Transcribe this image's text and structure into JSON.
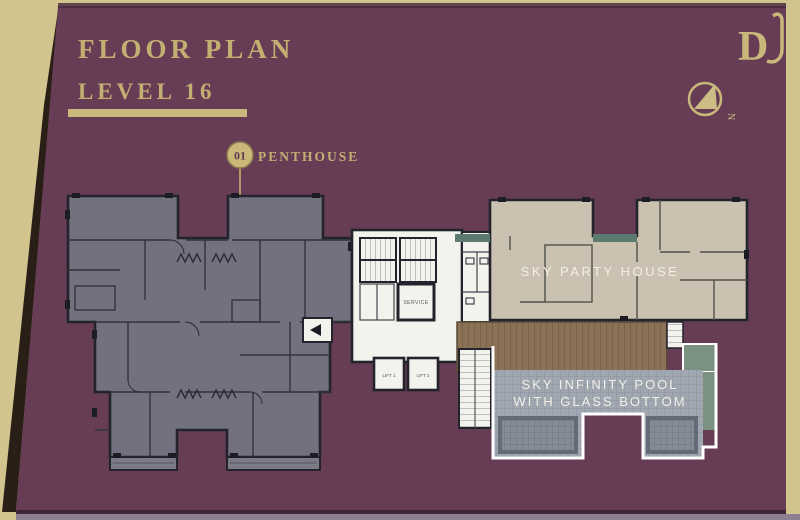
{
  "header": {
    "title_line1": "FLOOR PLAN",
    "title_line2": "LEVEL 16"
  },
  "legend": {
    "unit_number": "01",
    "unit_name": "PENTHOUSE"
  },
  "plan": {
    "party_house_label": "SKY PARTY HOUSE",
    "pool_label_line1": "SKY INFINITY POOL",
    "pool_label_line2": "WITH GLASS BOTTOM",
    "core": {
      "lift1": "LIFT 1",
      "lift2": "LIFT 2",
      "service": "SERVICE"
    }
  },
  "branding": {
    "logo_monogram": "D"
  },
  "compass": {
    "north_mark": "N"
  },
  "colors": {
    "page_cream": "#d2c48e",
    "panel_purple": "#673d56",
    "gold_accent": "#c6b074",
    "unit_gray": "#71717f",
    "wall_dark": "#23232c",
    "core_white": "#f4f2ec",
    "party_house_tan": "#cbc1b1",
    "planter_teal": "#5c7a6f",
    "deck_wood": "#8b7156",
    "lawn_green": "#7b9181",
    "pool_gray": "#a0a7b0",
    "label_white": "#f2efe8"
  }
}
